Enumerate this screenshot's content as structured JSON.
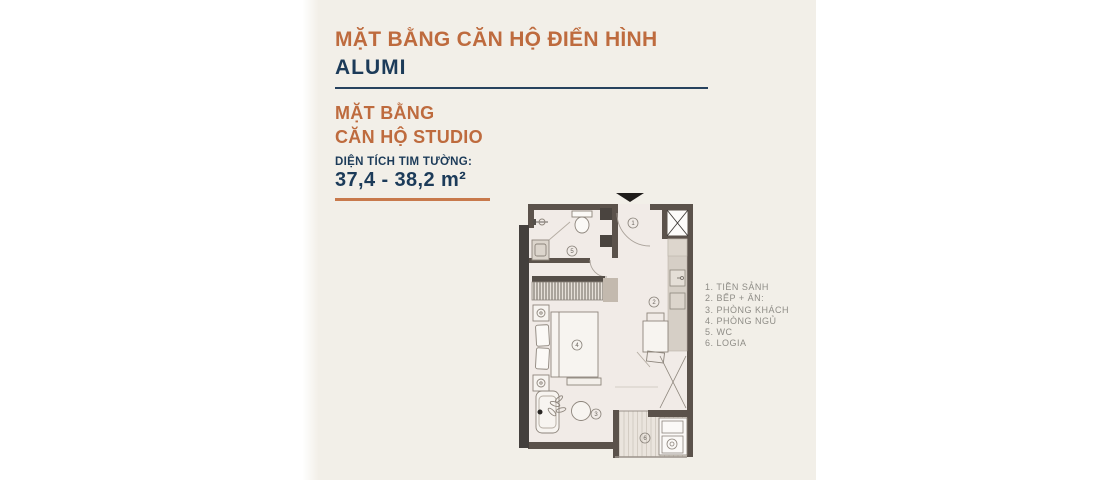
{
  "page": {
    "background": "#FFFFFF",
    "panel_color": "#F2EFE8"
  },
  "header": {
    "title_line1": "MẶT BẰNG CĂN HỘ ĐIỂN HÌNH",
    "title_line2": "ALUMI"
  },
  "subheader": {
    "line1": "MẶT BẰNG",
    "line2": "CĂN HỘ STUDIO",
    "area_label": "DIỆN TÍCH TIM TƯỜNG:",
    "area_value": "37,4 - 38,2 m²"
  },
  "legend": {
    "items": [
      "1. TIỀN SẢNH",
      "2. BẾP + ĂN:",
      "3. PHÒNG KHÁCH",
      "4. PHÒNG NGỦ",
      "5. WC",
      "6. LOGIA"
    ]
  },
  "plan": {
    "room_numbers": [
      "1",
      "2",
      "3",
      "4",
      "5",
      "6"
    ]
  },
  "colors": {
    "accent_orange": "#BE6B3E",
    "divider_orange": "#C8794B",
    "navy": "#1C3B59",
    "legend_gray": "#8E8C86",
    "wall_brown": "#5B524B",
    "wall_dark": "#44403D",
    "panel_cream": "#F2EFE8"
  }
}
